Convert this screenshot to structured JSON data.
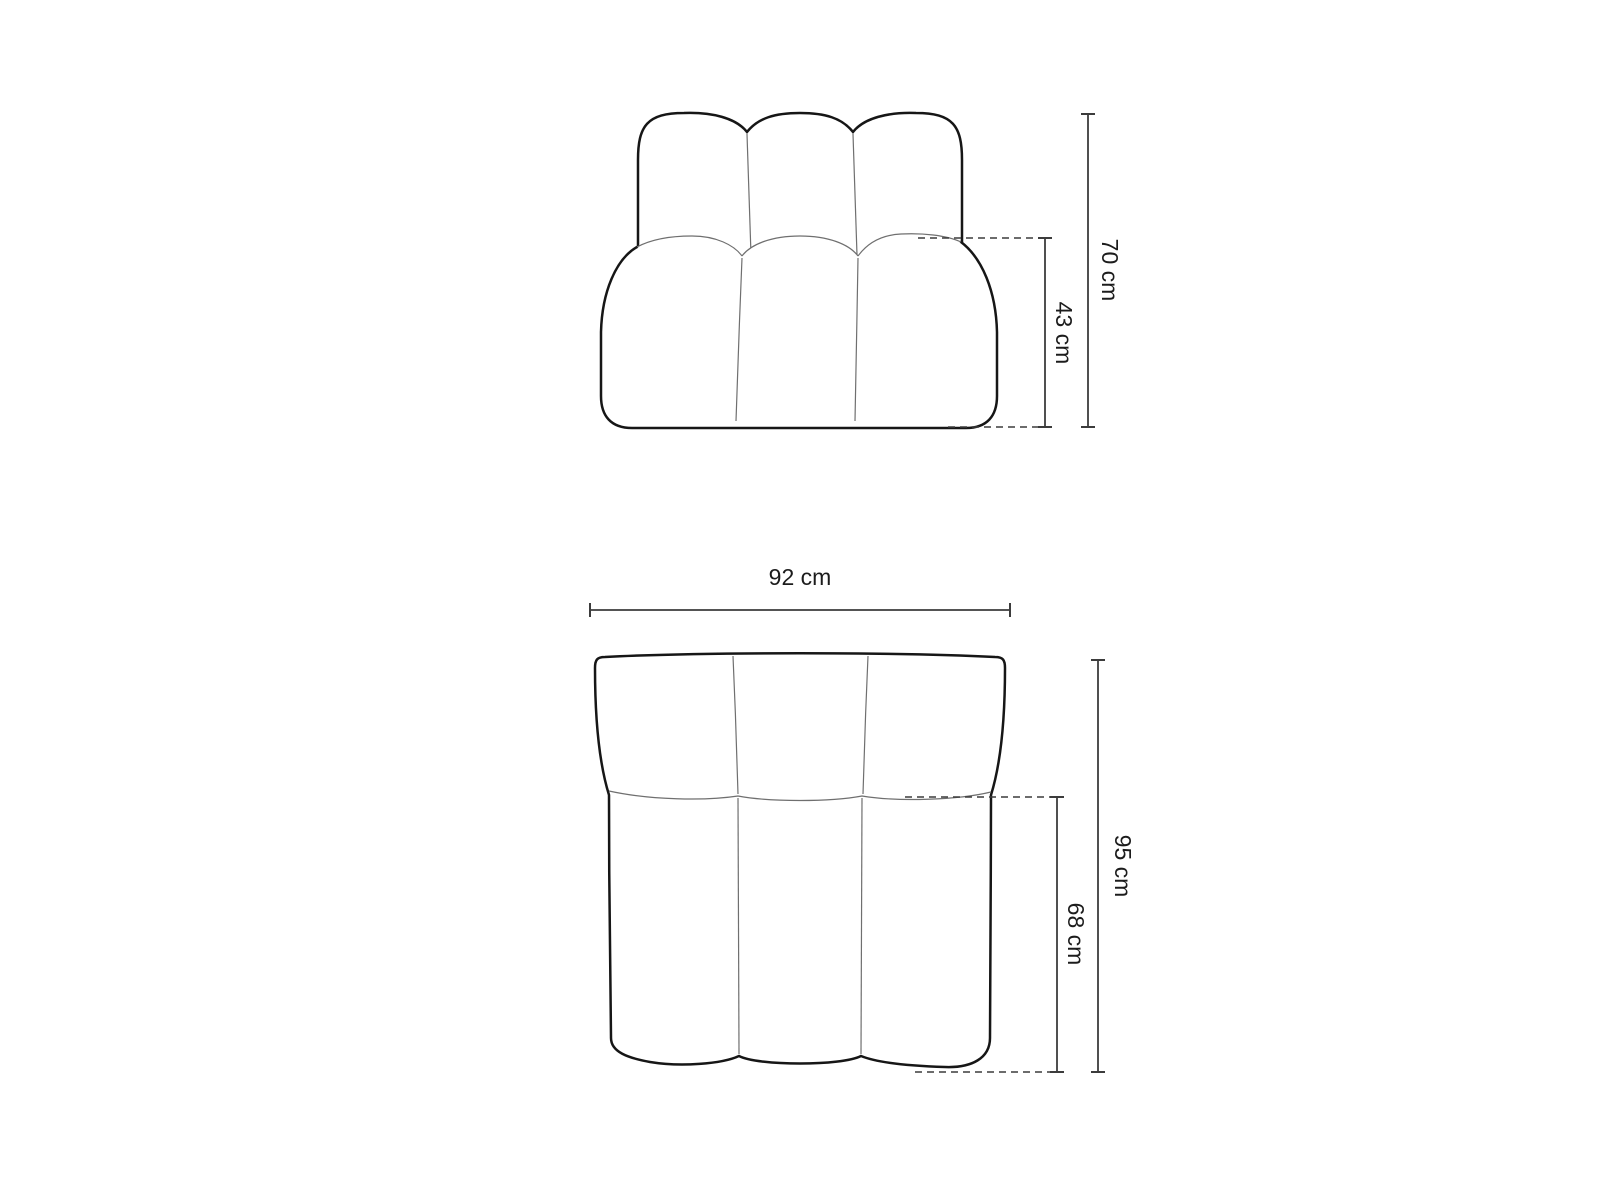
{
  "page": {
    "background": "#ffffff",
    "outline_color": "#161616",
    "seam_color": "#6f6f6f",
    "dim_line_color": "#3c3c3c",
    "text_color": "#1c1c1c"
  },
  "figure": {
    "title": "sofa-module-dimension-diagram",
    "views": {
      "front": {
        "name": "front-elevation",
        "dimensions": [
          {
            "id": "total_height",
            "label": "70 cm",
            "value_cm": 70,
            "orientation": "vertical"
          },
          {
            "id": "seat_height",
            "label": "43 cm",
            "value_cm": 43,
            "orientation": "vertical"
          }
        ]
      },
      "top": {
        "name": "top-plan",
        "dimensions": [
          {
            "id": "total_width",
            "label": "92 cm",
            "value_cm": 92,
            "orientation": "horizontal"
          },
          {
            "id": "total_depth",
            "label": "95 cm",
            "value_cm": 95,
            "orientation": "vertical"
          },
          {
            "id": "seat_depth",
            "label": "68 cm",
            "value_cm": 68,
            "orientation": "vertical"
          }
        ]
      }
    }
  }
}
